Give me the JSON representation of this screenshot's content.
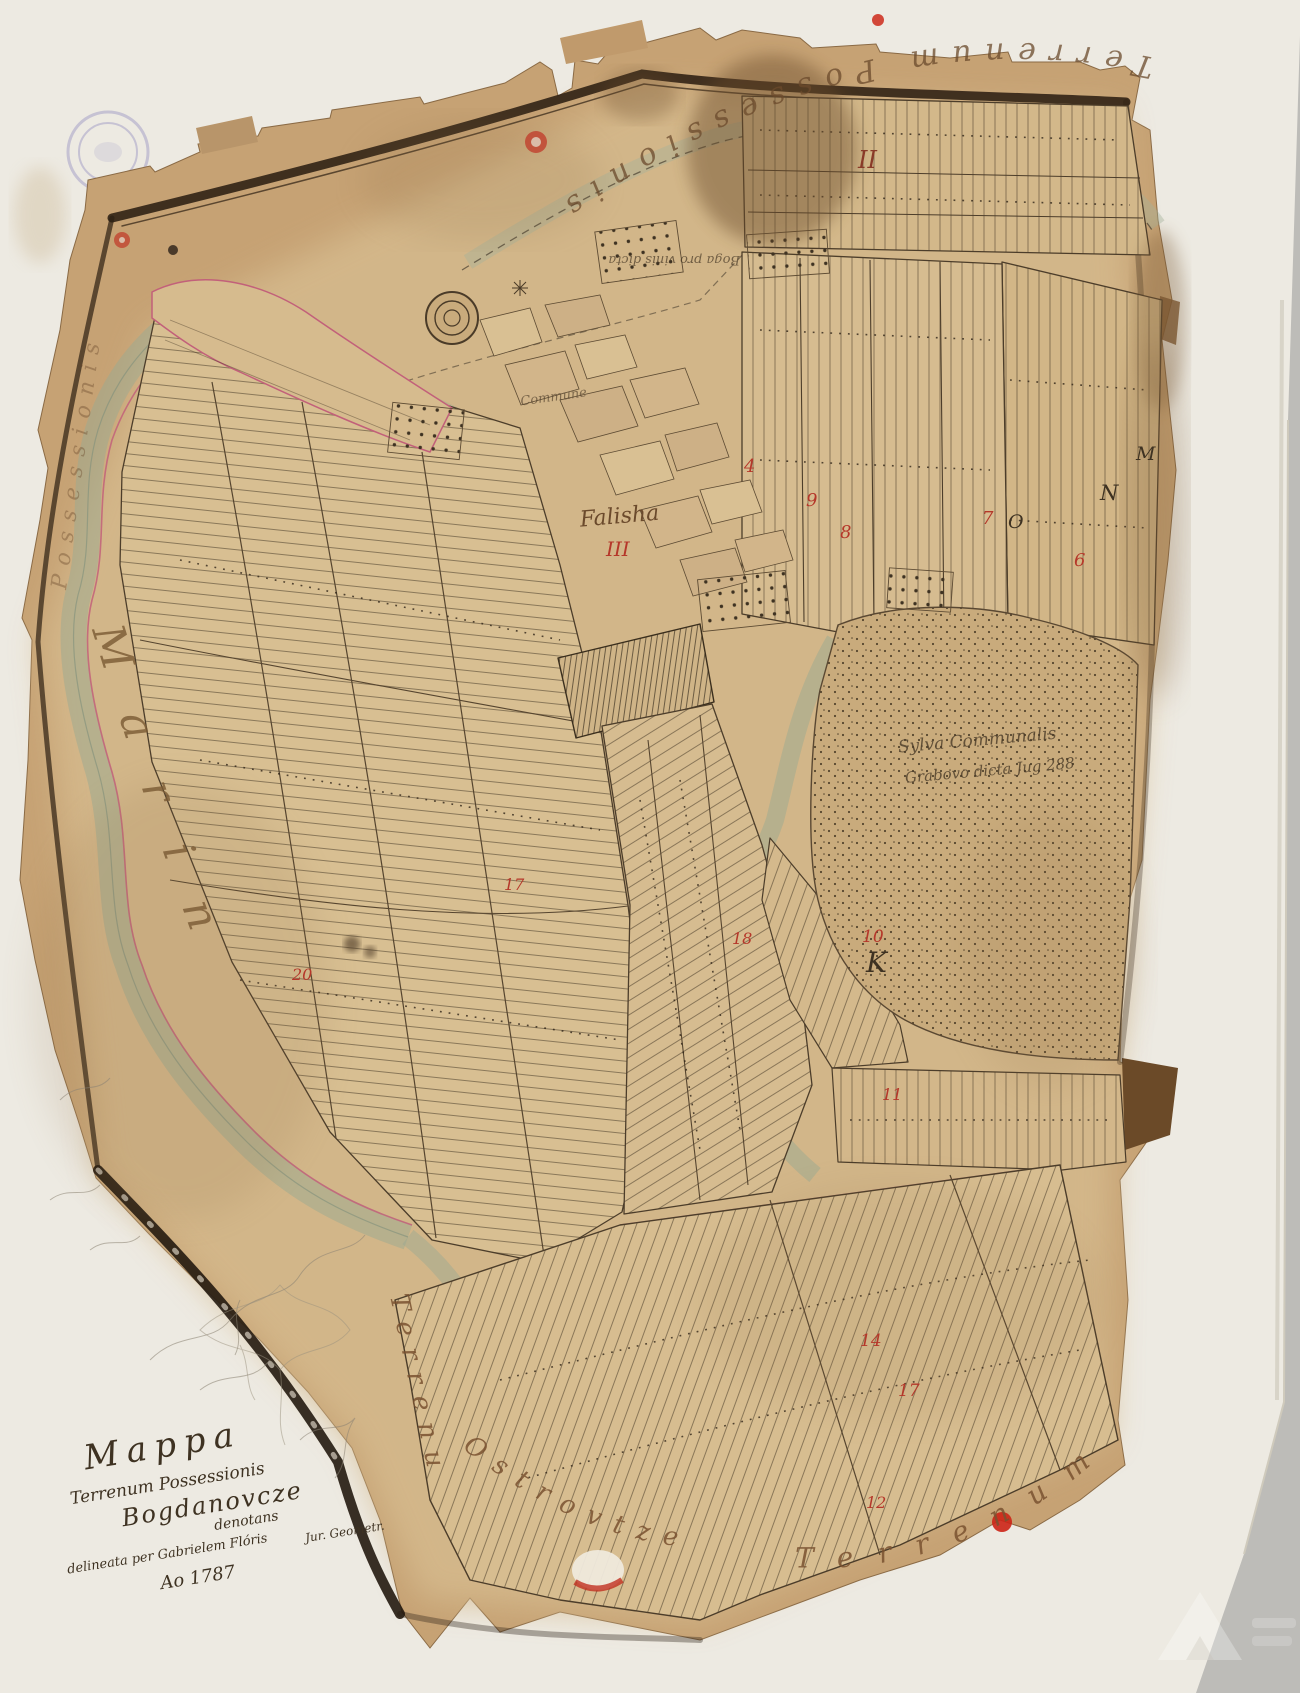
{
  "document": {
    "type_label": "Manuscript cadastral map, hand drawn, 1787",
    "title_block": {
      "line1": "Mappa",
      "line2": "Terrenum Possessionis",
      "line3": "Bogdanovcze",
      "line4": "denotans",
      "line5": "delineata per Gabrielem Flóris",
      "line6": "Jur. Geometr.",
      "line7": "Ao 1787"
    },
    "edge_labels": {
      "top": "Terrenum Possessionis Bersadin",
      "left_upper": "Possessionis",
      "left_lower": "Marin",
      "bottom_left_vertical": "Terrenum",
      "bottom_left_curved": "Ostrovtze",
      "bottom_right": "Terrenum"
    },
    "interior_labels": {
      "pasture": "Commune",
      "falisha": "Falisha",
      "falisha_numeral": "III",
      "vineyard_note": "Boga pro vinis dicta",
      "forest_line1": "Sylva Communalis",
      "forest_line2": "Grabovo dicta Jug 288"
    },
    "section_marks": {
      "roman_top": "II",
      "letter_k": "K",
      "letter_n": "N",
      "letter_m": "M",
      "letter_o": "O",
      "red_4": "4",
      "red_6": "6",
      "red_7": "7",
      "red_8": "8",
      "red_9": "9",
      "red_10": "10",
      "red_11": "11",
      "red_12": "12",
      "red_14": "14",
      "red_17": "17",
      "red_17b": "17",
      "red_18": "18",
      "red_20": "20"
    },
    "colors": {
      "paper": "#c9a678",
      "paper_light": "#d8bf94",
      "backing_cloth": "#edeae2",
      "table_grey": "#bdbcb8",
      "frame_brown": "#2c1f12",
      "river_green": "#9aa992",
      "boundary_pink": "#c2607a",
      "ink": "#4a3b28",
      "red_mark": "#b5372a"
    }
  }
}
